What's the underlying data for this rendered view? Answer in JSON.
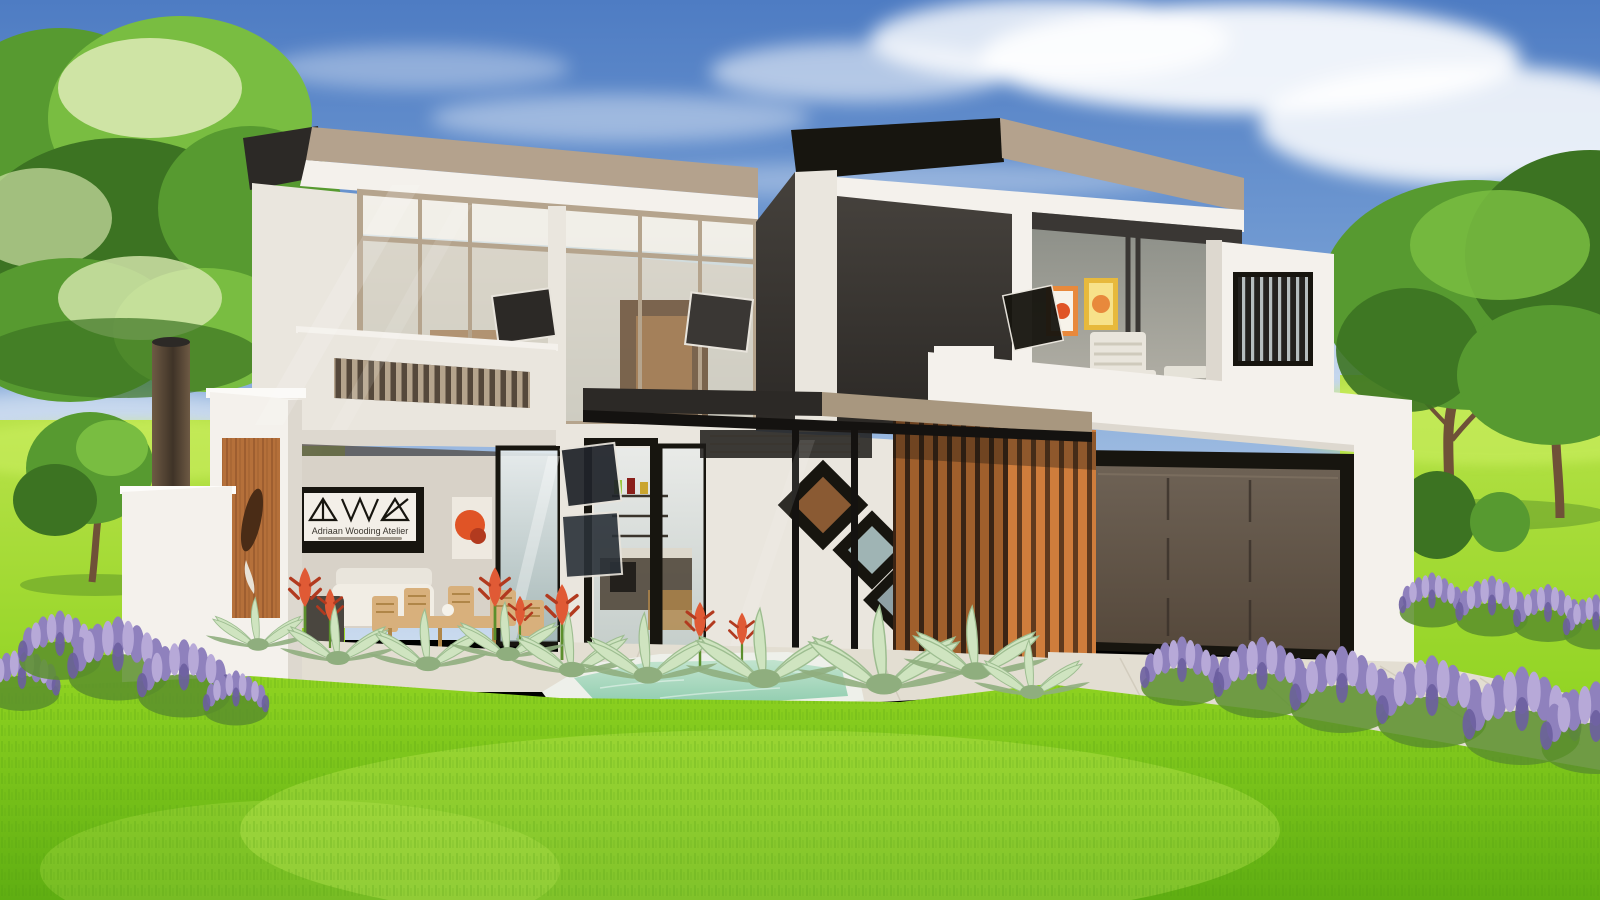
{
  "scene": {
    "title": "Modern double-storey house exterior — architectural render",
    "setting": "Daytime garden scene with lawn, trees, lavender beds, aloes, plunge pool and paved driveway",
    "signage": {
      "studio_name": "Adriaan Wooding Atelier"
    }
  },
  "colors": {
    "sky_top": "#4e7cc3",
    "sky_mid": "#7aa2d6",
    "sky_low": "#c9daee",
    "cloud": "#ffffff",
    "lawn_back": "#b9e24a",
    "lawn_mid": "#8fd321",
    "lawn_deep": "#5fae12",
    "grass_blade": "#4e9a10",
    "grass_hi": "#cdf163",
    "tree_dark": "#3c7322",
    "tree_main": "#579a30",
    "tree_light": "#79bd41",
    "tree_pale": "#d8e8b0",
    "trunk": "#6f5138",
    "lavender_light": "#b7a9d8",
    "lavender_main": "#8f81bd",
    "lavender_dark": "#6c5fa0",
    "lavender_stem": "#5b8f2c",
    "aloe_leaf": "#cfe4c0",
    "aloe_edge": "#9dbd90",
    "aloe_core": "#8fae7e",
    "flower_red": "#e05a35",
    "flower_red_dark": "#b23a1f",
    "wall_white": "#f4f1ec",
    "wall_cream": "#eae6de",
    "wall_shade": "#ddd8cf",
    "patio_wall": "#d8d2c8",
    "charcoal": "#45413c",
    "charcoal_deep": "#2c2926",
    "black_trim": "#17150f",
    "roof_fascia": "#b4a28d",
    "roof_fascia_dark": "#a8977f",
    "frame_tan": "#b5a48d",
    "mullion_dark": "#3a3734",
    "glass_light": "#e8eef0",
    "glass_mid": "#9fb4b4",
    "glass_dark": "#8a8d86",
    "glass_warm": "#b5b2a8",
    "garage_hi": "#6e6255",
    "garage_lo": "#55483b",
    "timber_bright": "#cf7d3c",
    "timber_mid": "#a05f2c",
    "timber_gap": "#5f3a1e",
    "timber_gap_dark": "#3a2415",
    "timber_panel": "#b5703a",
    "timber_grain": "#8a4f26",
    "timber_carve": "#4a2c16",
    "chimney_hi": "#6e5a44",
    "chimney_lo": "#3f3327",
    "paving": "#e3ded2",
    "paving_line": "#cfc8ba",
    "pool_hi": "#c2e4cf",
    "pool_lo": "#8fccae",
    "coping": "#eef0ea",
    "art_orange": "#e8893c",
    "art_yellow": "#e7b93c",
    "art_red": "#e05426",
    "wood_warm": "#a8835c",
    "wood_deep": "#6b5138",
    "furn_tan": "#d8b07c",
    "furn_tan_dark": "#b08648",
    "sofa": "#e9e5dc",
    "interior_cream": "#d9d2c4",
    "sign_bg": "#f3efe8",
    "sign_ink": "#3a362f",
    "louver_slat": "#cfd8db"
  }
}
